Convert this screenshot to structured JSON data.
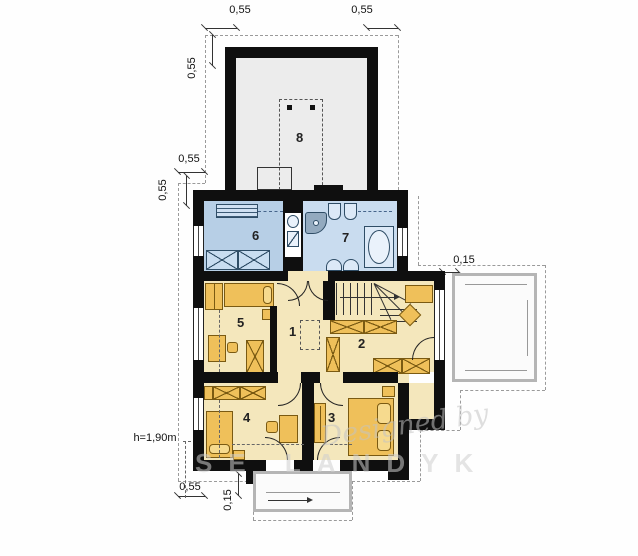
{
  "dims": {
    "top_left": "0,55",
    "top_right": "0,55",
    "garage_side": "0,55",
    "step_h": "0,55",
    "step_v": "0,55",
    "right_offset": "0,15",
    "bottom_left": "0,55",
    "bottom_offset": "0,15",
    "headroom": "h=1,90m"
  },
  "rooms": {
    "r1": "1",
    "r2": "2",
    "r3": "3",
    "r4": "4",
    "r5": "5",
    "r6": "6",
    "r7": "7",
    "r8": "8"
  },
  "watermark": {
    "line1": "Designed by",
    "line2": "SE LANDYK"
  },
  "colors": {
    "wall": "#0f0f0f",
    "bedroom_floor": "#f4e7bc",
    "bath_floor": "#c9dcef",
    "utility_floor": "#b7cfe6",
    "garage_floor": "#ececec",
    "furniture": "#efc05a",
    "dashed_line": "#9a9a9a"
  }
}
